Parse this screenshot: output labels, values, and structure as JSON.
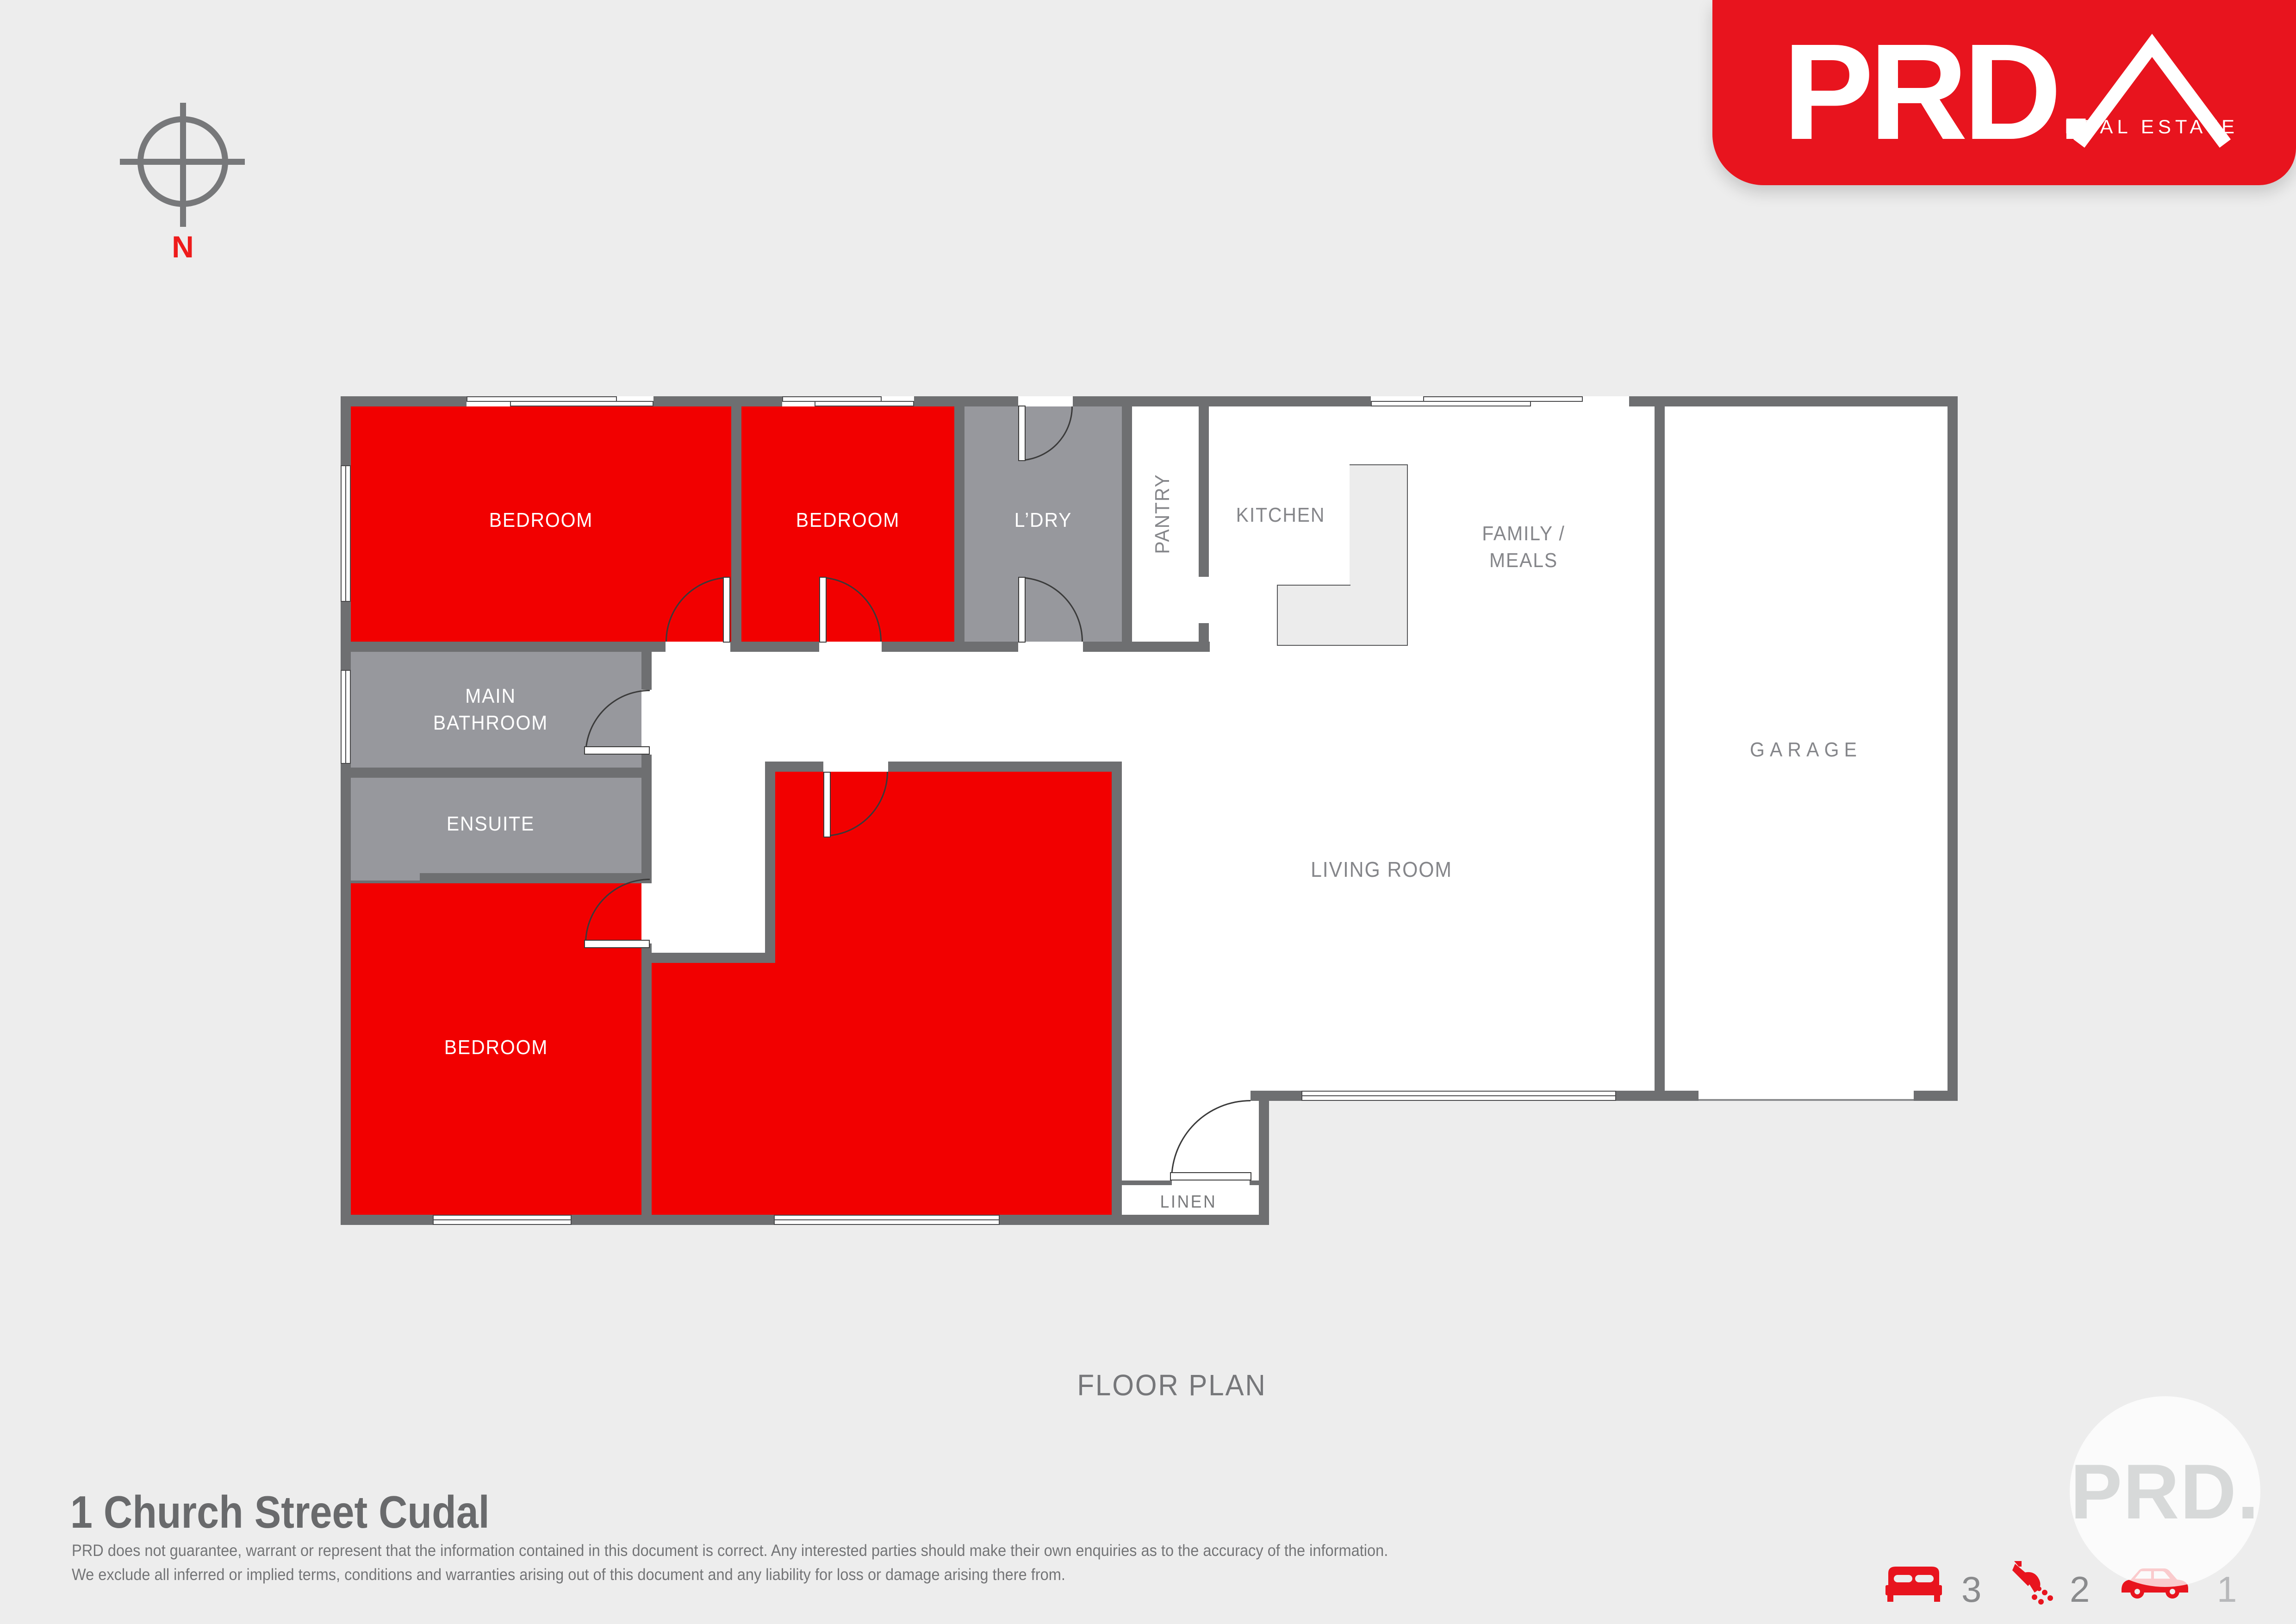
{
  "logo": {
    "brand": "PRD.",
    "tagline": "REAL ESTATE",
    "color": "#e8141e"
  },
  "compass": {
    "label": "N"
  },
  "plan": {
    "title": "FLOOR PLAN",
    "labels": {
      "bedroom1": "BEDROOM",
      "bedroom2": "BEDROOM",
      "laundry": "L’DRY",
      "pantry": "PANTRY",
      "kitchen": "KITCHEN",
      "family_line1": "FAMILY /",
      "family_line2": "MEALS",
      "garage": "GARAGE",
      "bathroom_line1": "MAIN",
      "bathroom_line2": "BATHROOM",
      "ensuite": "ENSUITE",
      "bedroom3": "BEDROOM",
      "living": "LIVING ROOM",
      "linen": "LINEN"
    },
    "colors": {
      "room_red": "#f20000",
      "room_gray": "#97989d",
      "wall": "#6e6f71",
      "floor": "#ffffff"
    }
  },
  "footer": {
    "address": "1 Church Street Cudal",
    "disclaimer_line1": "PRD does not guarantee, warrant or represent that the information contained in this document is correct. Any interested parties should make their own enquiries as to the accuracy of the information.",
    "disclaimer_line2": "We exclude all inferred or implied terms, conditions and warranties arising out of this document and any liability for loss or damage arising there from.",
    "stats": {
      "beds": "3",
      "baths": "2",
      "cars": "1"
    },
    "icons": {
      "beds": "bed-icon",
      "baths": "shower-icon",
      "cars": "car-icon"
    }
  },
  "watermark": {
    "text": "PRD."
  }
}
